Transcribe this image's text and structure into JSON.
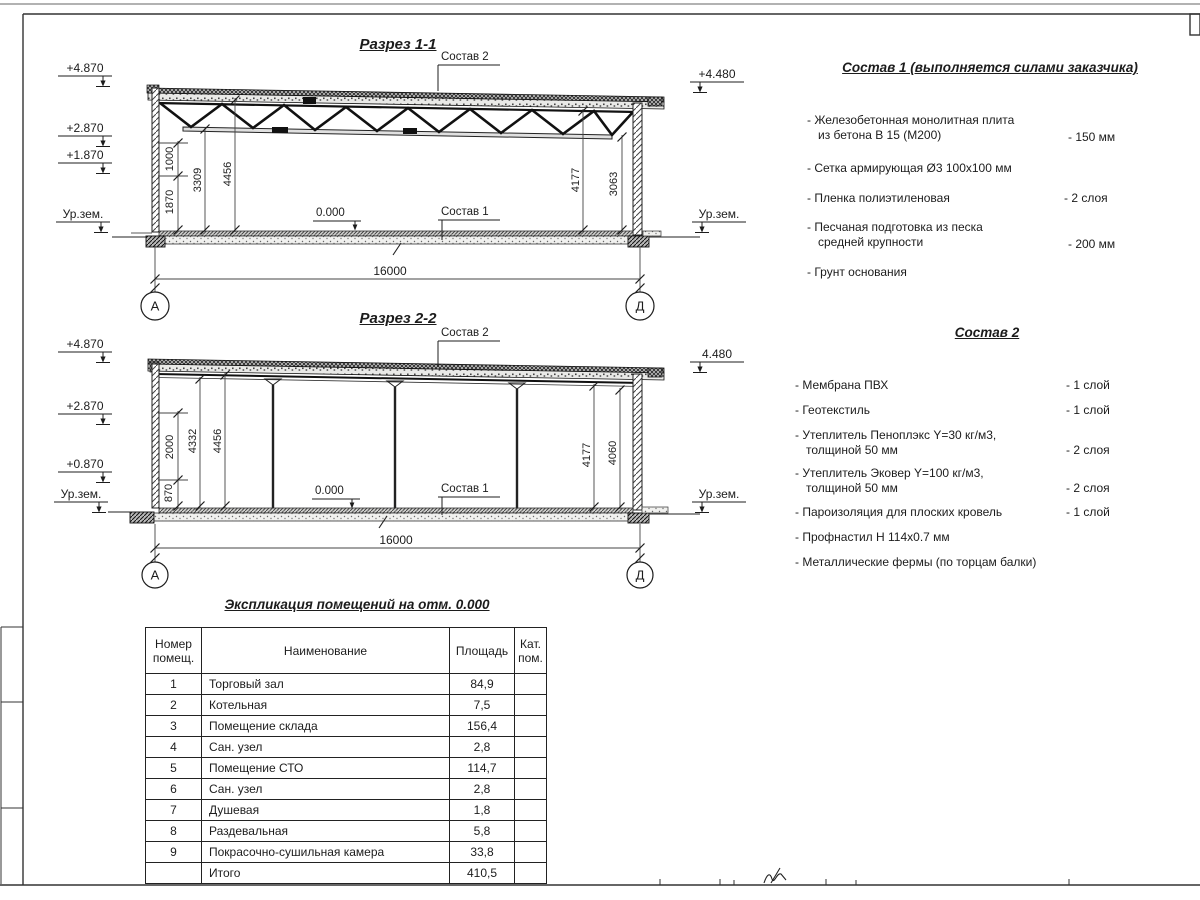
{
  "section1": {
    "title": "Разрез 1-1",
    "labels": {
      "sostav2": "Состав 2",
      "sostav1": "Состав 1",
      "zero": "0.000",
      "span": "16000",
      "axis_left": "А",
      "axis_right": "Д"
    },
    "elevations": {
      "p4870": "+4.870",
      "p2870": "+2.870",
      "p1870": "+1.870",
      "ground_left": "Ур.зем.",
      "p4480": "+4.480",
      "ground_right": "Ур.зем."
    },
    "dims": {
      "d1000": "1000",
      "d1870": "1870",
      "d3309": "3309",
      "d4456": "4456",
      "d4177": "4177",
      "d3063": "3063"
    }
  },
  "section2": {
    "title": "Разрез 2-2",
    "labels": {
      "sostav2": "Состав 2",
      "sostav1": "Состав 1",
      "zero": "0.000",
      "span": "16000",
      "axis_left": "А",
      "axis_right": "Д"
    },
    "elevations": {
      "p4870": "+4.870",
      "p2870": "+2.870",
      "p0870": "+0.870",
      "ground_left": "Ур.зем.",
      "p4480": "4.480",
      "ground_right": "Ур.зем."
    },
    "dims": {
      "d2000": "2000",
      "d870": "870",
      "d4332": "4332",
      "d4456": "4456",
      "d4177": "4177",
      "d4060": "4060"
    }
  },
  "sostav1": {
    "title": "Состав 1 (выполняется силами заказчика)",
    "items": [
      {
        "text": "- Железобетонная  монолитная плита\nиз бетона В 15 (М200)",
        "value": "- 150 мм"
      },
      {
        "text": "- Сетка армирующая Ø3 100х100 мм",
        "value": ""
      },
      {
        "text": "- Пленка полиэтиленовая",
        "value": "-  2 слоя"
      },
      {
        "text": "- Песчаная подготовка из песка\nсредней крупности",
        "value": "- 200 мм"
      },
      {
        "text": "- Грунт основания",
        "value": ""
      }
    ]
  },
  "sostav2": {
    "title": "Состав 2",
    "items": [
      {
        "text": "- Мембрана ПВХ",
        "value": "- 1 слой"
      },
      {
        "text": "- Геотекстиль",
        "value": "- 1 слой"
      },
      {
        "text": "- Утеплитель Пеноплэкс Y=30 кг/м3,\nтолщиной 50 мм",
        "value": "- 2 слоя"
      },
      {
        "text": "- Утеплитель Эковер Y=100 кг/м3,\nтолщиной 50 мм",
        "value": "- 2 слоя"
      },
      {
        "text": "- Пароизоляция для плоских кровель",
        "value": "- 1 слой"
      },
      {
        "text": "- Профнастил Н 114х0.7 мм",
        "value": ""
      },
      {
        "text": "- Металлические фермы (по торцам балки)",
        "value": ""
      }
    ]
  },
  "table": {
    "title": "Экспликация помещений на отм. 0.000",
    "headers": {
      "num": "Номер\nпомещ.",
      "name": "Наименование",
      "area": "Площадь",
      "cat": "Кат.\nпом."
    },
    "rows": [
      {
        "num": "1",
        "name": "Торговый зал",
        "area": "84,9",
        "cat": ""
      },
      {
        "num": "2",
        "name": "Котельная",
        "area": "7,5",
        "cat": ""
      },
      {
        "num": "3",
        "name": "Помещение склада",
        "area": "156,4",
        "cat": ""
      },
      {
        "num": "4",
        "name": "Сан. узел",
        "area": "2,8",
        "cat": ""
      },
      {
        "num": "5",
        "name": "Помещение СТО",
        "area": "114,7",
        "cat": ""
      },
      {
        "num": "6",
        "name": "Сан. узел",
        "area": "2,8",
        "cat": ""
      },
      {
        "num": "7",
        "name": "Душевая",
        "area": "1,8",
        "cat": ""
      },
      {
        "num": "8",
        "name": "Раздевальная",
        "area": "5,8",
        "cat": ""
      },
      {
        "num": "9",
        "name": "Покрасочно-сушильная камера",
        "area": "33,8",
        "cat": ""
      },
      {
        "num": "",
        "name": "Итого",
        "area": "410,5",
        "cat": ""
      }
    ]
  }
}
